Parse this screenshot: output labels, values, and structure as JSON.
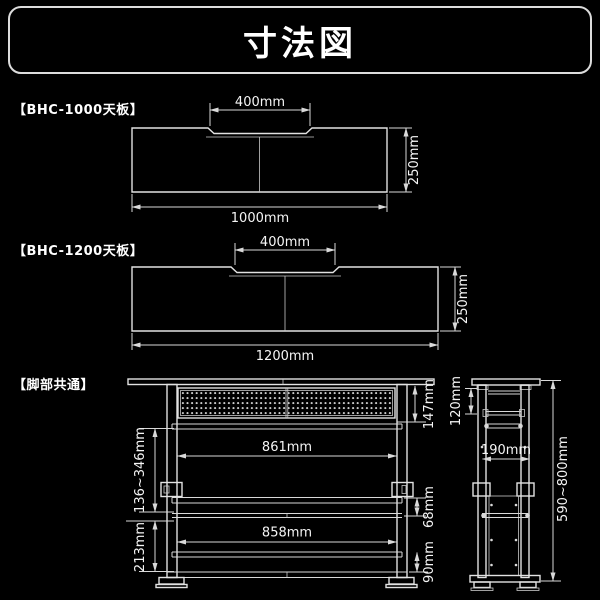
{
  "title": "寸法図",
  "colors": {
    "background": "#000000",
    "line": "#d9d9d9",
    "text": "#ffffff"
  },
  "sections": {
    "top1000": {
      "label": "【BHC-1000天板】",
      "dim_top": "400mm",
      "dim_side": "250mm",
      "dim_bottom": "1000mm"
    },
    "top1200": {
      "label": "【BHC-1200天板】",
      "dim_top": "400mm",
      "dim_side": "250mm",
      "dim_bottom": "1200mm"
    },
    "legs": {
      "label": "【脚部共通】",
      "front": {
        "panel_height": "147mm",
        "adjust_range": "136~346mm",
        "upper_width": "861mm",
        "rail_gap": "68mm",
        "lower_width": "858mm",
        "lower_section": "213mm",
        "base_height": "90mm"
      },
      "side": {
        "top_section": "120mm",
        "depth": "190mm",
        "height_range": "590~800mm"
      }
    }
  }
}
